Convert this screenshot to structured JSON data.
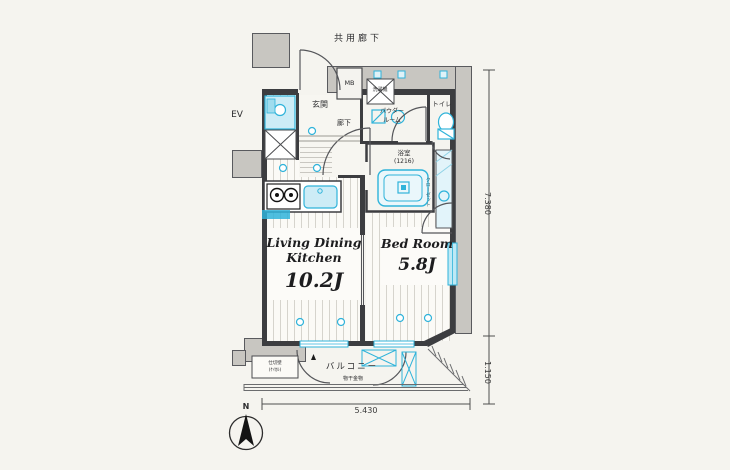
{
  "labels": {
    "common_corridor": "共用廊下",
    "elevator": "EV",
    "meter_box": "MB",
    "entrance": "玄関",
    "hallway": "廊下",
    "washing_machine": "洗濯機",
    "powder_room_line1": "パウダー",
    "powder_room_line2": "ルーム",
    "toilet": "トイレ",
    "bathroom": "浴室",
    "bathroom_size": "(1216)",
    "closet": "クローゼット",
    "living_line1": "Living Dining",
    "living_line2": "Kitchen",
    "living_size": "10.2J",
    "bedroom": "Bed Room",
    "bedroom_size": "5.8J",
    "balcony": "バルコニー",
    "drying_fixture": "物干金物",
    "partition_line1": "仕切壁",
    "partition_line2": "(ｹｲｶﾙ)",
    "north": "N"
  },
  "dimensions": {
    "width": "5.430",
    "height": "7.380",
    "balcony_depth": "1.150"
  },
  "colors": {
    "fixture_blue": "#2fb3da",
    "wall": "#3c3d40",
    "gray_area": "#c8c6c1",
    "background": "#f5f4ef"
  }
}
